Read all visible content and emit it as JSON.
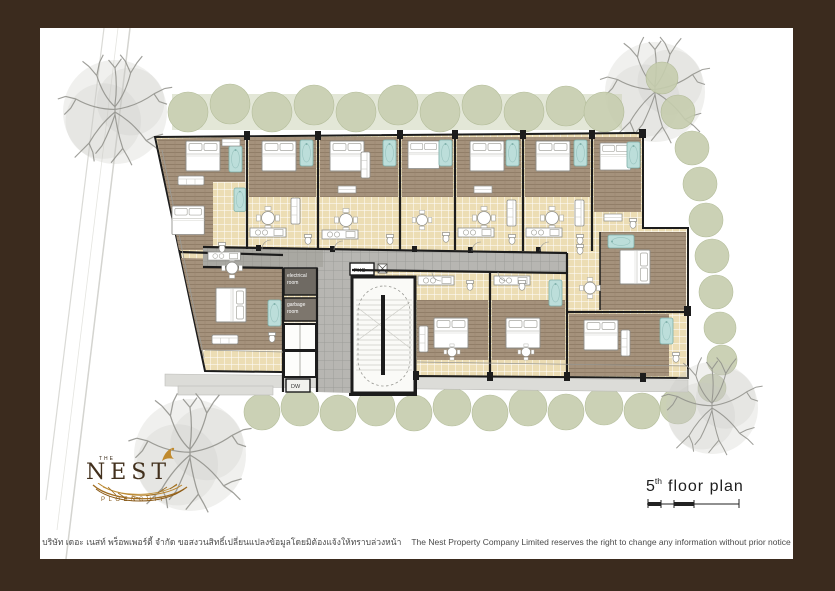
{
  "plan": {
    "labels": {
      "electrical_line1": "electrical",
      "electrical_line2": "room",
      "garbage_line1": "garbage",
      "garbage_line2": "room",
      "fhc": "FHC",
      "dw": "DW"
    },
    "palette": {
      "frame_brown": "#3b2b1e",
      "wall_black": "#1c1c1c",
      "tile_beige": "#ecddb4",
      "wood_brown": "#a5927c",
      "corridor_gray": "#b7b6b2",
      "water_teal": "#bcdeda",
      "hedge_green": "#c6cdae",
      "tree_gray": "#8e8e88",
      "service_dark": "#6f6a63",
      "service_mid": "#7d766d"
    }
  },
  "logo": {
    "the": "THE",
    "name": "NEST",
    "subtitle": "PLOENCHIT"
  },
  "caption": {
    "floor_number": "5",
    "ordinal": "th",
    "label": "floor plan"
  },
  "footer": {
    "thai": "บริษัท เดอะ เนสท์ พร็อพเพอร์ตี้ จำกัด ขอสงวนสิทธิ์เปลี่ยนแปลงข้อมูลโดยมิต้องแจ้งให้ทราบล่วงหน้า",
    "english": "The Nest Property Company Limited reserves the right to change any information without prior notice"
  }
}
